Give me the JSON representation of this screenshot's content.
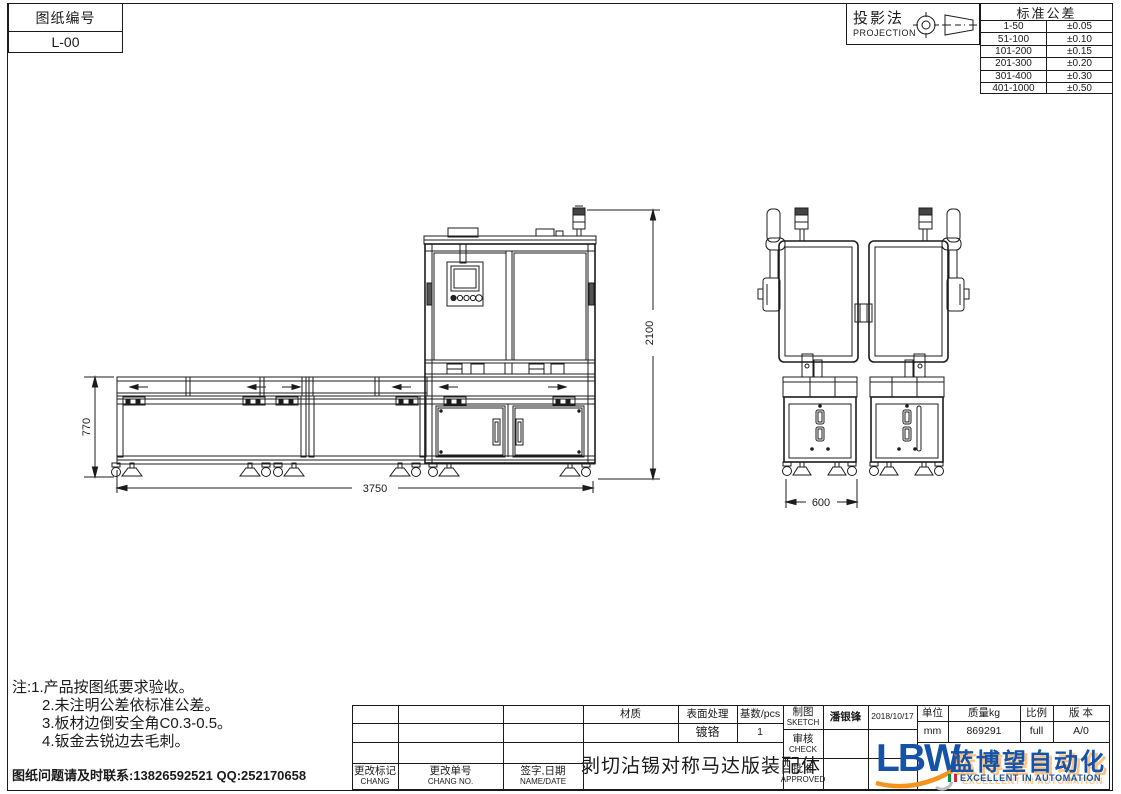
{
  "sheet": {
    "drawing_no_label": "图纸编号",
    "drawing_no": "L-00"
  },
  "projection": {
    "label": "投影法",
    "sublabel": "PROJECTION"
  },
  "tolerance": {
    "title": "标准公差",
    "rows": [
      {
        "range": "1-50",
        "value": "±0.05"
      },
      {
        "range": "51-100",
        "value": "±0.10"
      },
      {
        "range": "101-200",
        "value": "±0.15"
      },
      {
        "range": "201-300",
        "value": "±0.20"
      },
      {
        "range": "301-400",
        "value": "±0.30"
      },
      {
        "range": "401-1000",
        "value": "±0.50"
      }
    ]
  },
  "dimensions": {
    "table_height": "770",
    "machine_height": "2100",
    "total_length": "3750",
    "unit_width": "600"
  },
  "notes": {
    "line1": "注:1.产品按图纸要求验收。",
    "line2": "2.未注明公差依标准公差。",
    "line3": "3.板材边倒安全角C0.3-0.5。",
    "line4": "4.钣金去锐边去毛刺。",
    "contact": "图纸问题请及时联系:13826592521 QQ:252170658"
  },
  "title_block": {
    "material_label": "材质",
    "surface_label": "表面处理",
    "surface_value": "镀铬",
    "qty_label": "基数/pcs",
    "qty_value": "1",
    "sketch_label": "制图",
    "sketch_sublabel": "SKETCH",
    "sketch_name": "潘银锋",
    "sketch_date": "2018/10/17",
    "check_label": "审核",
    "check_sublabel": "CHECK",
    "approve_label": "批准",
    "approve_sublabel": "APPROVED",
    "unit_label": "单位",
    "unit_value": "mm",
    "weight_label": "质量kg",
    "weight_value": "869291",
    "scale_label": "比例",
    "scale_value": "full",
    "version_label": "版 本",
    "version_value": "A/0",
    "change_mark_label": "更改标记",
    "change_mark_sublabel": "CHANG",
    "change_no_label": "更改单号",
    "change_no_sublabel": "CHANG NO.",
    "sign_date_label": "签字,日期",
    "sign_date_sublabel": "NAME/DATE",
    "drawing_title": "剥切沾锡对称马达版装配体"
  },
  "logo": {
    "abbr": "LBW",
    "name_cn": "蓝博望自动化",
    "tagline": "EXCELLENT IN AUTOMATION"
  },
  "colors": {
    "line": "#1a1a1a",
    "logo_blue": "#1553a8",
    "logo_orange": "#f6921e"
  }
}
